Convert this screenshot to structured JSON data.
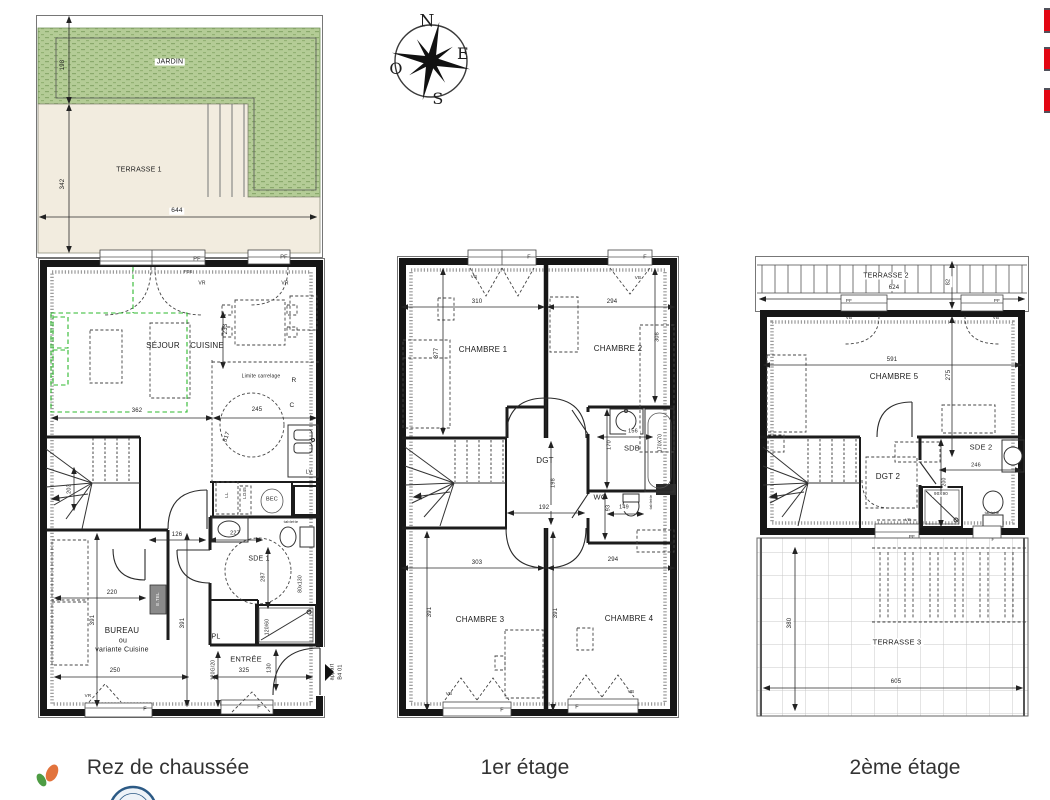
{
  "captions": {
    "ground": "Rez de chaussée",
    "first": "1er étage",
    "second": "2ème étage"
  },
  "colors": {
    "accent_red": "#e30613",
    "garden_green": "#b4cc96",
    "terrace_beige": "#f2ecdf",
    "wall_black": "#161616",
    "variant_green_dash": "#2db82d",
    "stamp_blue": "#2c5a85",
    "leaf_green": "#4e9c44",
    "leaf_orange": "#e2733c"
  },
  "labels": [
    {
      "t": "JARDIN",
      "x": 170,
      "y": 62,
      "s": 7,
      "c": "bg",
      "n": "room-label-jardin"
    },
    {
      "t": "TERRASSE 1",
      "x": 139,
      "y": 170,
      "s": 7,
      "n": "room-label-terrasse-1"
    },
    {
      "t": "198",
      "x": 63,
      "y": 65,
      "s": 6,
      "r": -90,
      "n": "dim-label"
    },
    {
      "t": "342",
      "x": 63,
      "y": 184,
      "s": 6,
      "r": -90,
      "n": "dim-label"
    },
    {
      "t": "644",
      "x": 177,
      "y": 211,
      "s": 6.5,
      "c": "bg",
      "n": "dim-label"
    },
    {
      "t": "PF",
      "x": 197,
      "y": 260,
      "s": 5.5,
      "n": "window-label"
    },
    {
      "t": "PF",
      "x": 284,
      "y": 258,
      "s": 5.5,
      "n": "window-label"
    },
    {
      "t": "F08",
      "x": 188,
      "y": 272,
      "s": 4.5,
      "n": "window-label"
    },
    {
      "t": "VR",
      "x": 202,
      "y": 284,
      "s": 5,
      "n": "window-label"
    },
    {
      "t": "VR",
      "x": 285,
      "y": 284,
      "s": 5,
      "n": "window-label"
    },
    {
      "t": "SÉJOUR",
      "x": 163,
      "y": 346,
      "s": 8,
      "n": "room-label-sejour"
    },
    {
      "t": "CUISINE",
      "x": 207,
      "y": 346,
      "s": 8,
      "n": "room-label-cuisine"
    },
    {
      "t": "233",
      "x": 226,
      "y": 329,
      "s": 6,
      "r": -90,
      "n": "dim-label"
    },
    {
      "t": "Limite carrelage",
      "x": 261,
      "y": 377,
      "s": 5,
      "c": "bg",
      "n": "note-label"
    },
    {
      "t": "R",
      "x": 294,
      "y": 381,
      "s": 6.5,
      "n": "note-label"
    },
    {
      "t": "C",
      "x": 292,
      "y": 406,
      "s": 6.5,
      "n": "note-label"
    },
    {
      "t": "362",
      "x": 137,
      "y": 411,
      "s": 6,
      "c": "bg",
      "n": "dim-label"
    },
    {
      "t": "245",
      "x": 257,
      "y": 410,
      "s": 6,
      "c": "bg",
      "n": "dim-label"
    },
    {
      "t": "317",
      "x": 227,
      "y": 437,
      "s": 6,
      "r": -70,
      "n": "dim-label"
    },
    {
      "t": "LV",
      "x": 309,
      "y": 473,
      "s": 5.5,
      "n": "fixture-label-lv"
    },
    {
      "t": "LL",
      "x": 227,
      "y": 495,
      "s": 4.5,
      "r": -90,
      "n": "fixture-label-ll"
    },
    {
      "t": "LO45",
      "x": 245,
      "y": 493,
      "s": 4.5,
      "r": -90,
      "n": "fixture-label"
    },
    {
      "t": "BEC",
      "x": 272,
      "y": 500,
      "s": 5.5,
      "n": "fixture-label-bec"
    },
    {
      "t": "203",
      "x": 70,
      "y": 489,
      "s": 5.5,
      "r": -90,
      "n": "dim-label"
    },
    {
      "t": "126",
      "x": 177,
      "y": 535,
      "s": 6,
      "n": "dim-label"
    },
    {
      "t": "227",
      "x": 235,
      "y": 534,
      "s": 5.5,
      "n": "dim-label"
    },
    {
      "t": "tablette",
      "x": 291,
      "y": 522,
      "s": 4,
      "n": "fixture-label"
    },
    {
      "t": "SDE 1",
      "x": 259,
      "y": 559,
      "s": 7,
      "n": "room-label-sde1"
    },
    {
      "t": "287",
      "x": 264,
      "y": 577,
      "s": 5.5,
      "r": -90,
      "n": "dim-label"
    },
    {
      "t": "80x130",
      "x": 301,
      "y": 584,
      "s": 5,
      "r": -90,
      "n": "dim-label"
    },
    {
      "t": "220",
      "x": 112,
      "y": 593,
      "s": 6,
      "n": "dim-label"
    },
    {
      "t": "E.TEL",
      "x": 158,
      "y": 599,
      "s": 4.5,
      "r": -90,
      "c": "etel",
      "n": "fixture-label-etel"
    },
    {
      "t": "391",
      "x": 93,
      "y": 620,
      "s": 6,
      "r": -90,
      "n": "dim-label"
    },
    {
      "t": "391",
      "x": 183,
      "y": 623,
      "s": 6,
      "r": -90,
      "n": "dim-label"
    },
    {
      "t": "BUREAU",
      "x": 122,
      "y": 631,
      "s": 8,
      "n": "room-label-bureau"
    },
    {
      "t": "ou",
      "x": 123,
      "y": 641,
      "s": 7,
      "n": "room-label-bureau"
    },
    {
      "t": "variante Cuisine",
      "x": 122,
      "y": 650,
      "s": 7,
      "n": "room-label-bureau"
    },
    {
      "t": "PL",
      "x": 216,
      "y": 637,
      "s": 7,
      "n": "room-label-pl"
    },
    {
      "t": "120/60",
      "x": 268,
      "y": 627,
      "s": 5,
      "r": -90,
      "n": "dim-label"
    },
    {
      "t": "ENTRÉE",
      "x": 246,
      "y": 659,
      "s": 7.5,
      "n": "room-label-entree"
    },
    {
      "t": "120G/20",
      "x": 214,
      "y": 670,
      "s": 5,
      "r": -90,
      "n": "dim-label"
    },
    {
      "t": "325",
      "x": 244,
      "y": 671,
      "s": 6,
      "n": "dim-label"
    },
    {
      "t": "130",
      "x": 270,
      "y": 668,
      "s": 5.5,
      "r": -90,
      "n": "dim-label"
    },
    {
      "t": "250",
      "x": 115,
      "y": 671,
      "s": 6,
      "n": "dim-label"
    },
    {
      "t": "appart",
      "x": 333,
      "y": 672,
      "s": 5.5,
      "r": -90,
      "n": "unit-label"
    },
    {
      "t": "B4 01",
      "x": 341,
      "y": 672,
      "s": 5.5,
      "r": -90,
      "n": "unit-label"
    },
    {
      "t": "VR",
      "x": 88,
      "y": 696,
      "s": 4.5,
      "n": "window-label"
    },
    {
      "t": "F",
      "x": 145,
      "y": 710,
      "s": 5.5,
      "n": "window-label"
    },
    {
      "t": "F",
      "x": 259,
      "y": 708,
      "s": 5.5,
      "n": "window-label"
    },
    {
      "t": "F",
      "x": 529,
      "y": 258,
      "s": 5.5,
      "n": "window-label"
    },
    {
      "t": "F",
      "x": 645,
      "y": 258,
      "s": 5.5,
      "n": "window-label"
    },
    {
      "t": "VB",
      "x": 474,
      "y": 277,
      "s": 4.5,
      "n": "window-label"
    },
    {
      "t": "VB",
      "x": 638,
      "y": 278,
      "s": 4.5,
      "n": "window-label"
    },
    {
      "t": "310",
      "x": 477,
      "y": 302,
      "s": 6,
      "c": "bg",
      "n": "dim-label"
    },
    {
      "t": "294",
      "x": 612,
      "y": 302,
      "s": 6,
      "c": "bg",
      "n": "dim-label"
    },
    {
      "t": "377",
      "x": 437,
      "y": 353,
      "s": 6,
      "r": -90,
      "n": "dim-label"
    },
    {
      "t": "308",
      "x": 658,
      "y": 337,
      "s": 5.5,
      "r": -90,
      "n": "dim-label"
    },
    {
      "t": "CHAMBRE 1",
      "x": 483,
      "y": 350,
      "s": 8,
      "n": "room-label-chambre1"
    },
    {
      "t": "CHAMBRE 2",
      "x": 618,
      "y": 349,
      "s": 8,
      "n": "room-label-chambre2"
    },
    {
      "t": "DGT",
      "x": 545,
      "y": 461,
      "s": 8,
      "n": "room-label-dgt"
    },
    {
      "t": "198",
      "x": 554,
      "y": 483,
      "s": 5.5,
      "r": -90,
      "n": "dim-label"
    },
    {
      "t": "SDB",
      "x": 632,
      "y": 448,
      "s": 7.5,
      "n": "room-label-sdb"
    },
    {
      "t": "156",
      "x": 633,
      "y": 432,
      "s": 5.5,
      "c": "bg",
      "n": "dim-label"
    },
    {
      "t": "170",
      "x": 610,
      "y": 445,
      "s": 5.5,
      "r": -90,
      "n": "dim-label"
    },
    {
      "t": "170X70",
      "x": 661,
      "y": 443,
      "s": 5,
      "r": -90,
      "n": "dim-label"
    },
    {
      "t": "WC",
      "x": 600,
      "y": 497,
      "s": 7.5,
      "n": "room-label-wc"
    },
    {
      "t": "93",
      "x": 609,
      "y": 508,
      "s": 5.5,
      "r": -90,
      "n": "dim-label"
    },
    {
      "t": "149",
      "x": 624,
      "y": 508,
      "s": 5.5,
      "c": "bg",
      "n": "dim-label"
    },
    {
      "t": "tablette",
      "x": 651,
      "y": 502,
      "s": 4,
      "r": -90,
      "n": "fixture-label"
    },
    {
      "t": "192",
      "x": 544,
      "y": 508,
      "s": 6,
      "c": "bg",
      "n": "dim-label"
    },
    {
      "t": "303",
      "x": 477,
      "y": 563,
      "s": 6,
      "c": "bg",
      "n": "dim-label"
    },
    {
      "t": "294",
      "x": 613,
      "y": 560,
      "s": 6,
      "c": "bg",
      "n": "dim-label"
    },
    {
      "t": "391",
      "x": 430,
      "y": 612,
      "s": 6,
      "r": -90,
      "n": "dim-label"
    },
    {
      "t": "391",
      "x": 556,
      "y": 613,
      "s": 6,
      "r": -90,
      "n": "dim-label"
    },
    {
      "t": "CHAMBRE 3",
      "x": 480,
      "y": 620,
      "s": 8,
      "n": "room-label-chambre3"
    },
    {
      "t": "CHAMBRE 4",
      "x": 629,
      "y": 619,
      "s": 8,
      "n": "room-label-chambre4"
    },
    {
      "t": "VB",
      "x": 449,
      "y": 694,
      "s": 4.5,
      "n": "window-label"
    },
    {
      "t": "VB",
      "x": 631,
      "y": 692,
      "s": 4.5,
      "n": "window-label"
    },
    {
      "t": "F",
      "x": 502,
      "y": 711,
      "s": 5.5,
      "n": "window-label"
    },
    {
      "t": "F",
      "x": 577,
      "y": 708,
      "s": 5.5,
      "n": "window-label"
    },
    {
      "t": "TERRASSE 2",
      "x": 886,
      "y": 276,
      "s": 7,
      "c": "bg",
      "n": "room-label-terrasse-2"
    },
    {
      "t": "624",
      "x": 894,
      "y": 288,
      "s": 6,
      "c": "bg",
      "n": "dim-label"
    },
    {
      "t": "82",
      "x": 949,
      "y": 282,
      "s": 5.5,
      "r": -90,
      "c": "bg",
      "n": "dim-label"
    },
    {
      "t": "PF",
      "x": 849,
      "y": 301,
      "s": 4.5,
      "n": "window-label"
    },
    {
      "t": "PF",
      "x": 997,
      "y": 301,
      "s": 4.5,
      "n": "window-label"
    },
    {
      "t": "VB",
      "x": 849,
      "y": 318,
      "s": 4.5,
      "n": "window-label"
    },
    {
      "t": "VB",
      "x": 996,
      "y": 318,
      "s": 4.5,
      "n": "window-label"
    },
    {
      "t": "591",
      "x": 892,
      "y": 360,
      "s": 6,
      "c": "bg",
      "n": "dim-label"
    },
    {
      "t": "CHAMBRE 5",
      "x": 894,
      "y": 377,
      "s": 8,
      "n": "room-label-chambre5"
    },
    {
      "t": "275",
      "x": 949,
      "y": 375,
      "s": 6,
      "r": -90,
      "n": "dim-label"
    },
    {
      "t": "SDE 2",
      "x": 981,
      "y": 447,
      "s": 7.5,
      "n": "room-label-sde2"
    },
    {
      "t": "246",
      "x": 976,
      "y": 466,
      "s": 5.5,
      "c": "bg",
      "n": "dim-label"
    },
    {
      "t": "DGT 2",
      "x": 888,
      "y": 477,
      "s": 8,
      "n": "room-label-dgt2"
    },
    {
      "t": "90X90",
      "x": 941,
      "y": 494,
      "s": 4.5,
      "c": "bg",
      "n": "dim-label"
    },
    {
      "t": "200",
      "x": 945,
      "y": 482,
      "s": 5,
      "r": -90,
      "c": "bg",
      "n": "dim-label"
    },
    {
      "t": "tablette",
      "x": 992,
      "y": 513,
      "s": 4,
      "n": "fixture-label"
    },
    {
      "t": "VR",
      "x": 908,
      "y": 520,
      "s": 4,
      "n": "window-label"
    },
    {
      "t": "PF",
      "x": 912,
      "y": 537,
      "s": 4.5,
      "n": "window-label"
    },
    {
      "t": "F",
      "x": 993,
      "y": 540,
      "s": 4.5,
      "n": "window-label"
    },
    {
      "t": "TERRASSE 3",
      "x": 897,
      "y": 642,
      "s": 7.5,
      "c": "bg",
      "n": "room-label-terrasse-3"
    },
    {
      "t": "605",
      "x": 896,
      "y": 682,
      "s": 6,
      "c": "bg",
      "n": "dim-label"
    },
    {
      "t": "380",
      "x": 790,
      "y": 623,
      "s": 6,
      "r": -90,
      "c": "bg",
      "n": "dim-label"
    },
    {
      "t": "N",
      "x": 427,
      "y": 22,
      "s": 17,
      "c": "compass",
      "n": "compass-north-label"
    },
    {
      "t": "E",
      "x": 463,
      "y": 54,
      "s": 16,
      "c": "compass",
      "n": "compass-east-label"
    },
    {
      "t": "S",
      "x": 438,
      "y": 99,
      "s": 16,
      "c": "compass",
      "n": "compass-south-label"
    },
    {
      "t": "O",
      "x": 396,
      "y": 69,
      "s": 16,
      "c": "compass",
      "n": "compass-west-label"
    }
  ]
}
